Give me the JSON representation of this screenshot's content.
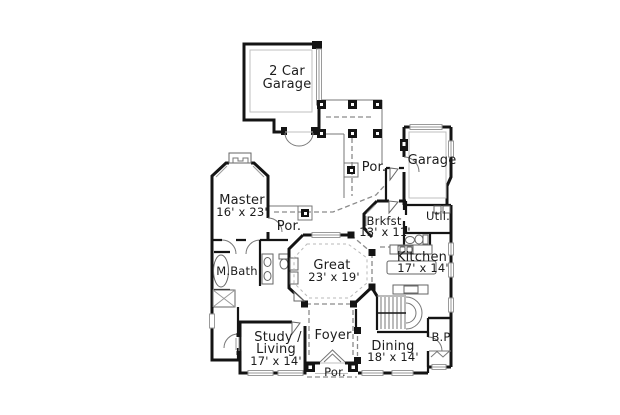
{
  "page": {
    "type": "floor-plan-drawing",
    "background": "#ffffff"
  },
  "colors": {
    "wall": "#141414",
    "thin_line": "#777777",
    "window": "#9a9a9a",
    "dashed": "#8a8a8a",
    "text": "#1c1c1c"
  },
  "plan": {
    "detached_garage": {
      "line1": "2 Car",
      "line2": "Garage"
    },
    "master": {
      "name": "Master",
      "dims": "16' x 23'"
    },
    "master_porch": {
      "name": "Por."
    },
    "walkway_porch": {
      "name": "Por."
    },
    "attached_garage": {
      "name": "Garage"
    },
    "breakfast": {
      "name": "Brkfst.",
      "dims": "13' x 11'"
    },
    "utility": {
      "name": "Util."
    },
    "master_bath": {
      "name": "M.Bath"
    },
    "great_room": {
      "name": "Great",
      "dims": "23' x 19'"
    },
    "kitchen": {
      "name": "Kitchen",
      "dims": "17' x 14'"
    },
    "study": {
      "line1": "Study /",
      "line2": "Living",
      "dims": "17' x 14'"
    },
    "foyer": {
      "name": "Foyer"
    },
    "front_porch": {
      "name": "Por."
    },
    "dining": {
      "name": "Dining",
      "dims": "18' x 14'"
    },
    "butlers_pantry": {
      "name": "B.P"
    }
  }
}
